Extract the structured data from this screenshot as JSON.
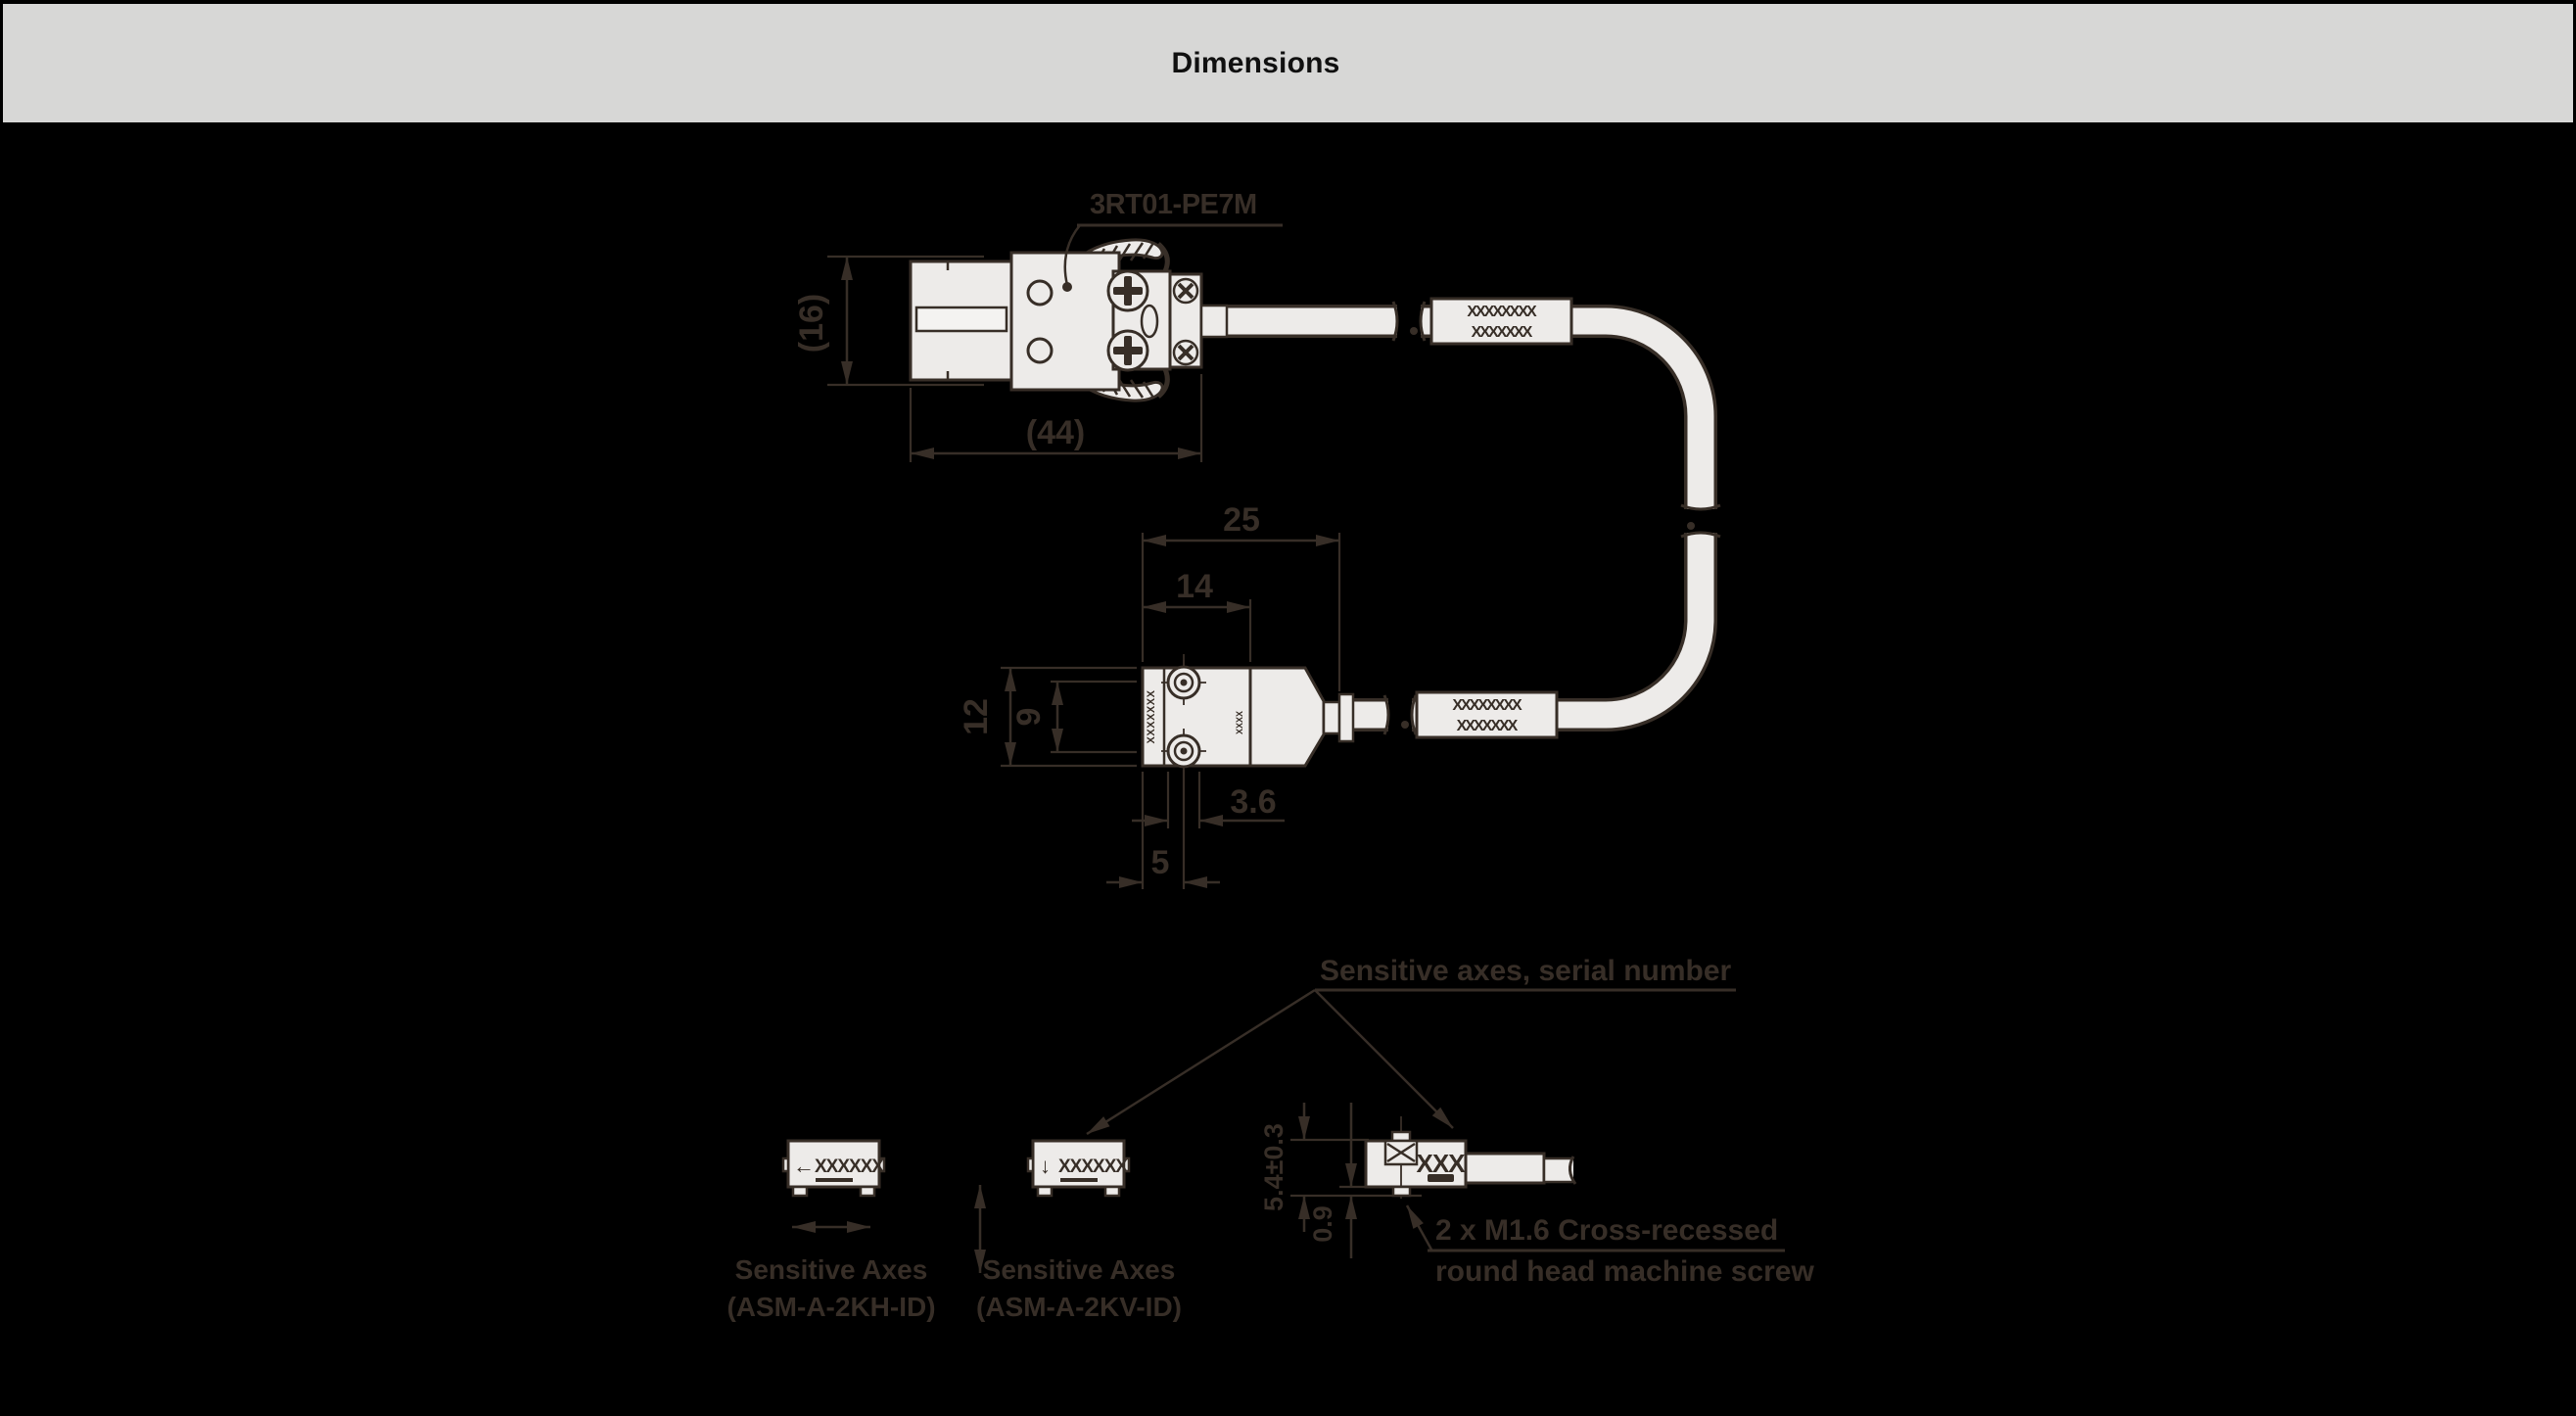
{
  "header": {
    "title": "Dimensions"
  },
  "connector": {
    "label": "3RT01-PE7M"
  },
  "dims": {
    "conn_height": "(16)",
    "conn_length": "(44)",
    "sensor_total_len": "25",
    "sensor_body_len": "14",
    "sensor_height": "12",
    "sensor_inner_height": "9",
    "boss_dia": "3.6",
    "screw_offset": "5",
    "side_height": "5.4±0.3",
    "side_standoff": "0.9"
  },
  "markings": {
    "sleeve_row1": "XXXXXXXX",
    "sleeve_row2": "XXXXXXX",
    "sensor_side": "XXXXXXX",
    "sensor_edge": "XXXX",
    "side_view": "XXX",
    "axis_view": "XXXXXX"
  },
  "annotations": {
    "serial": "Sensitive axes, serial number",
    "screw1": "2 x M1.6 Cross-recessed",
    "screw2": "round head machine screw"
  },
  "views": {
    "horizontal": {
      "arrow": "←",
      "caption1": "Sensitive Axes",
      "caption2": "(ASM-A-2KH-ID)"
    },
    "vertical": {
      "arrow": "↓",
      "caption1": "Sensitive Axes",
      "caption2": "(ASM-A-2KV-ID)"
    }
  },
  "colors": {
    "background": "#000000",
    "header_bg": "#d7d7d6",
    "ink": "#372e27",
    "fill_light": "#edebe9"
  }
}
